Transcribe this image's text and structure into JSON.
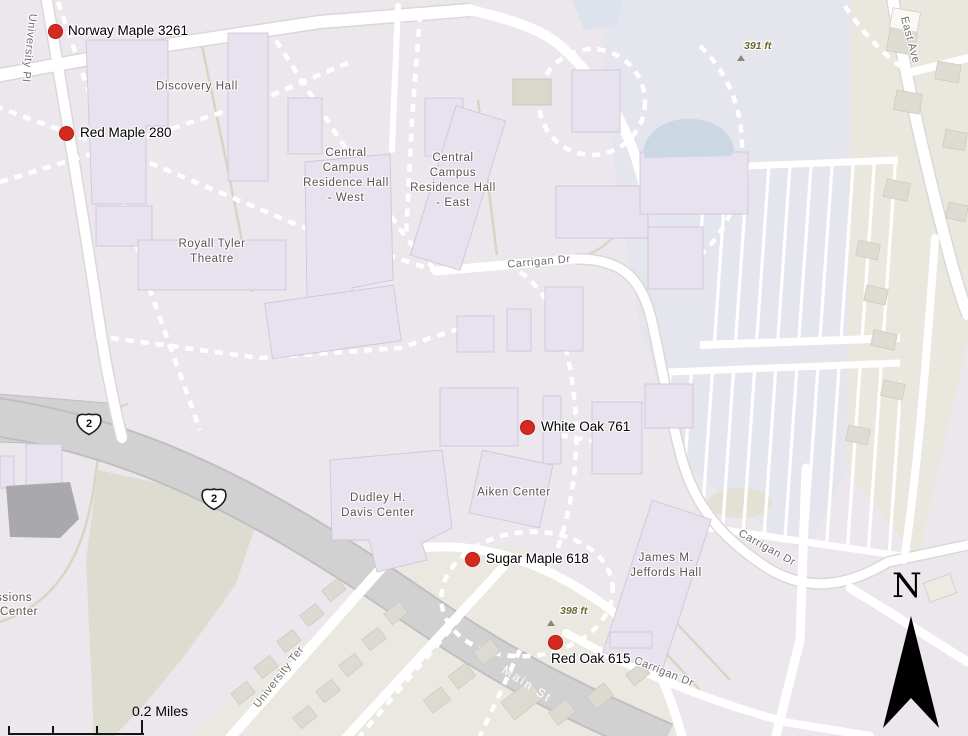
{
  "colors": {
    "marker": "#d62a1e",
    "building_fill": "#e8e1ee",
    "road_gray": "#d2d2d2"
  },
  "markers": [
    {
      "label": "Norway Maple 3261"
    },
    {
      "label": "Red Maple 280"
    },
    {
      "label": "White Oak 761"
    },
    {
      "label": "Sugar Maple 618"
    },
    {
      "label": "Red Oak 615"
    }
  ],
  "buildings": [
    {
      "label": "Discovery Hall"
    },
    {
      "label": "Royall Tyler\nTheatre"
    },
    {
      "label": "Central\nCampus\nResidence Hall\n- West"
    },
    {
      "label": "Central\nCampus\nResidence Hall\n- East"
    },
    {
      "label": "Dudley H.\nDavis Center"
    },
    {
      "label": "Aiken Center"
    },
    {
      "label": "James M.\nJeffords Hall"
    }
  ],
  "partial_labels": [
    {
      "label": "ssions"
    },
    {
      "label": "Center"
    }
  ],
  "streets": {
    "university_pl": "University Pl",
    "east_ave": "East Ave",
    "carrigan_dr": "Carrigan Dr",
    "main_st": "Main St",
    "university_ter": "University Ter"
  },
  "elevations": [
    {
      "label": "391 ft"
    },
    {
      "label": "398 ft"
    }
  ],
  "route_shield": {
    "label": "2"
  },
  "north": {
    "label": "N"
  },
  "scale": {
    "label": "0.2 Miles"
  }
}
